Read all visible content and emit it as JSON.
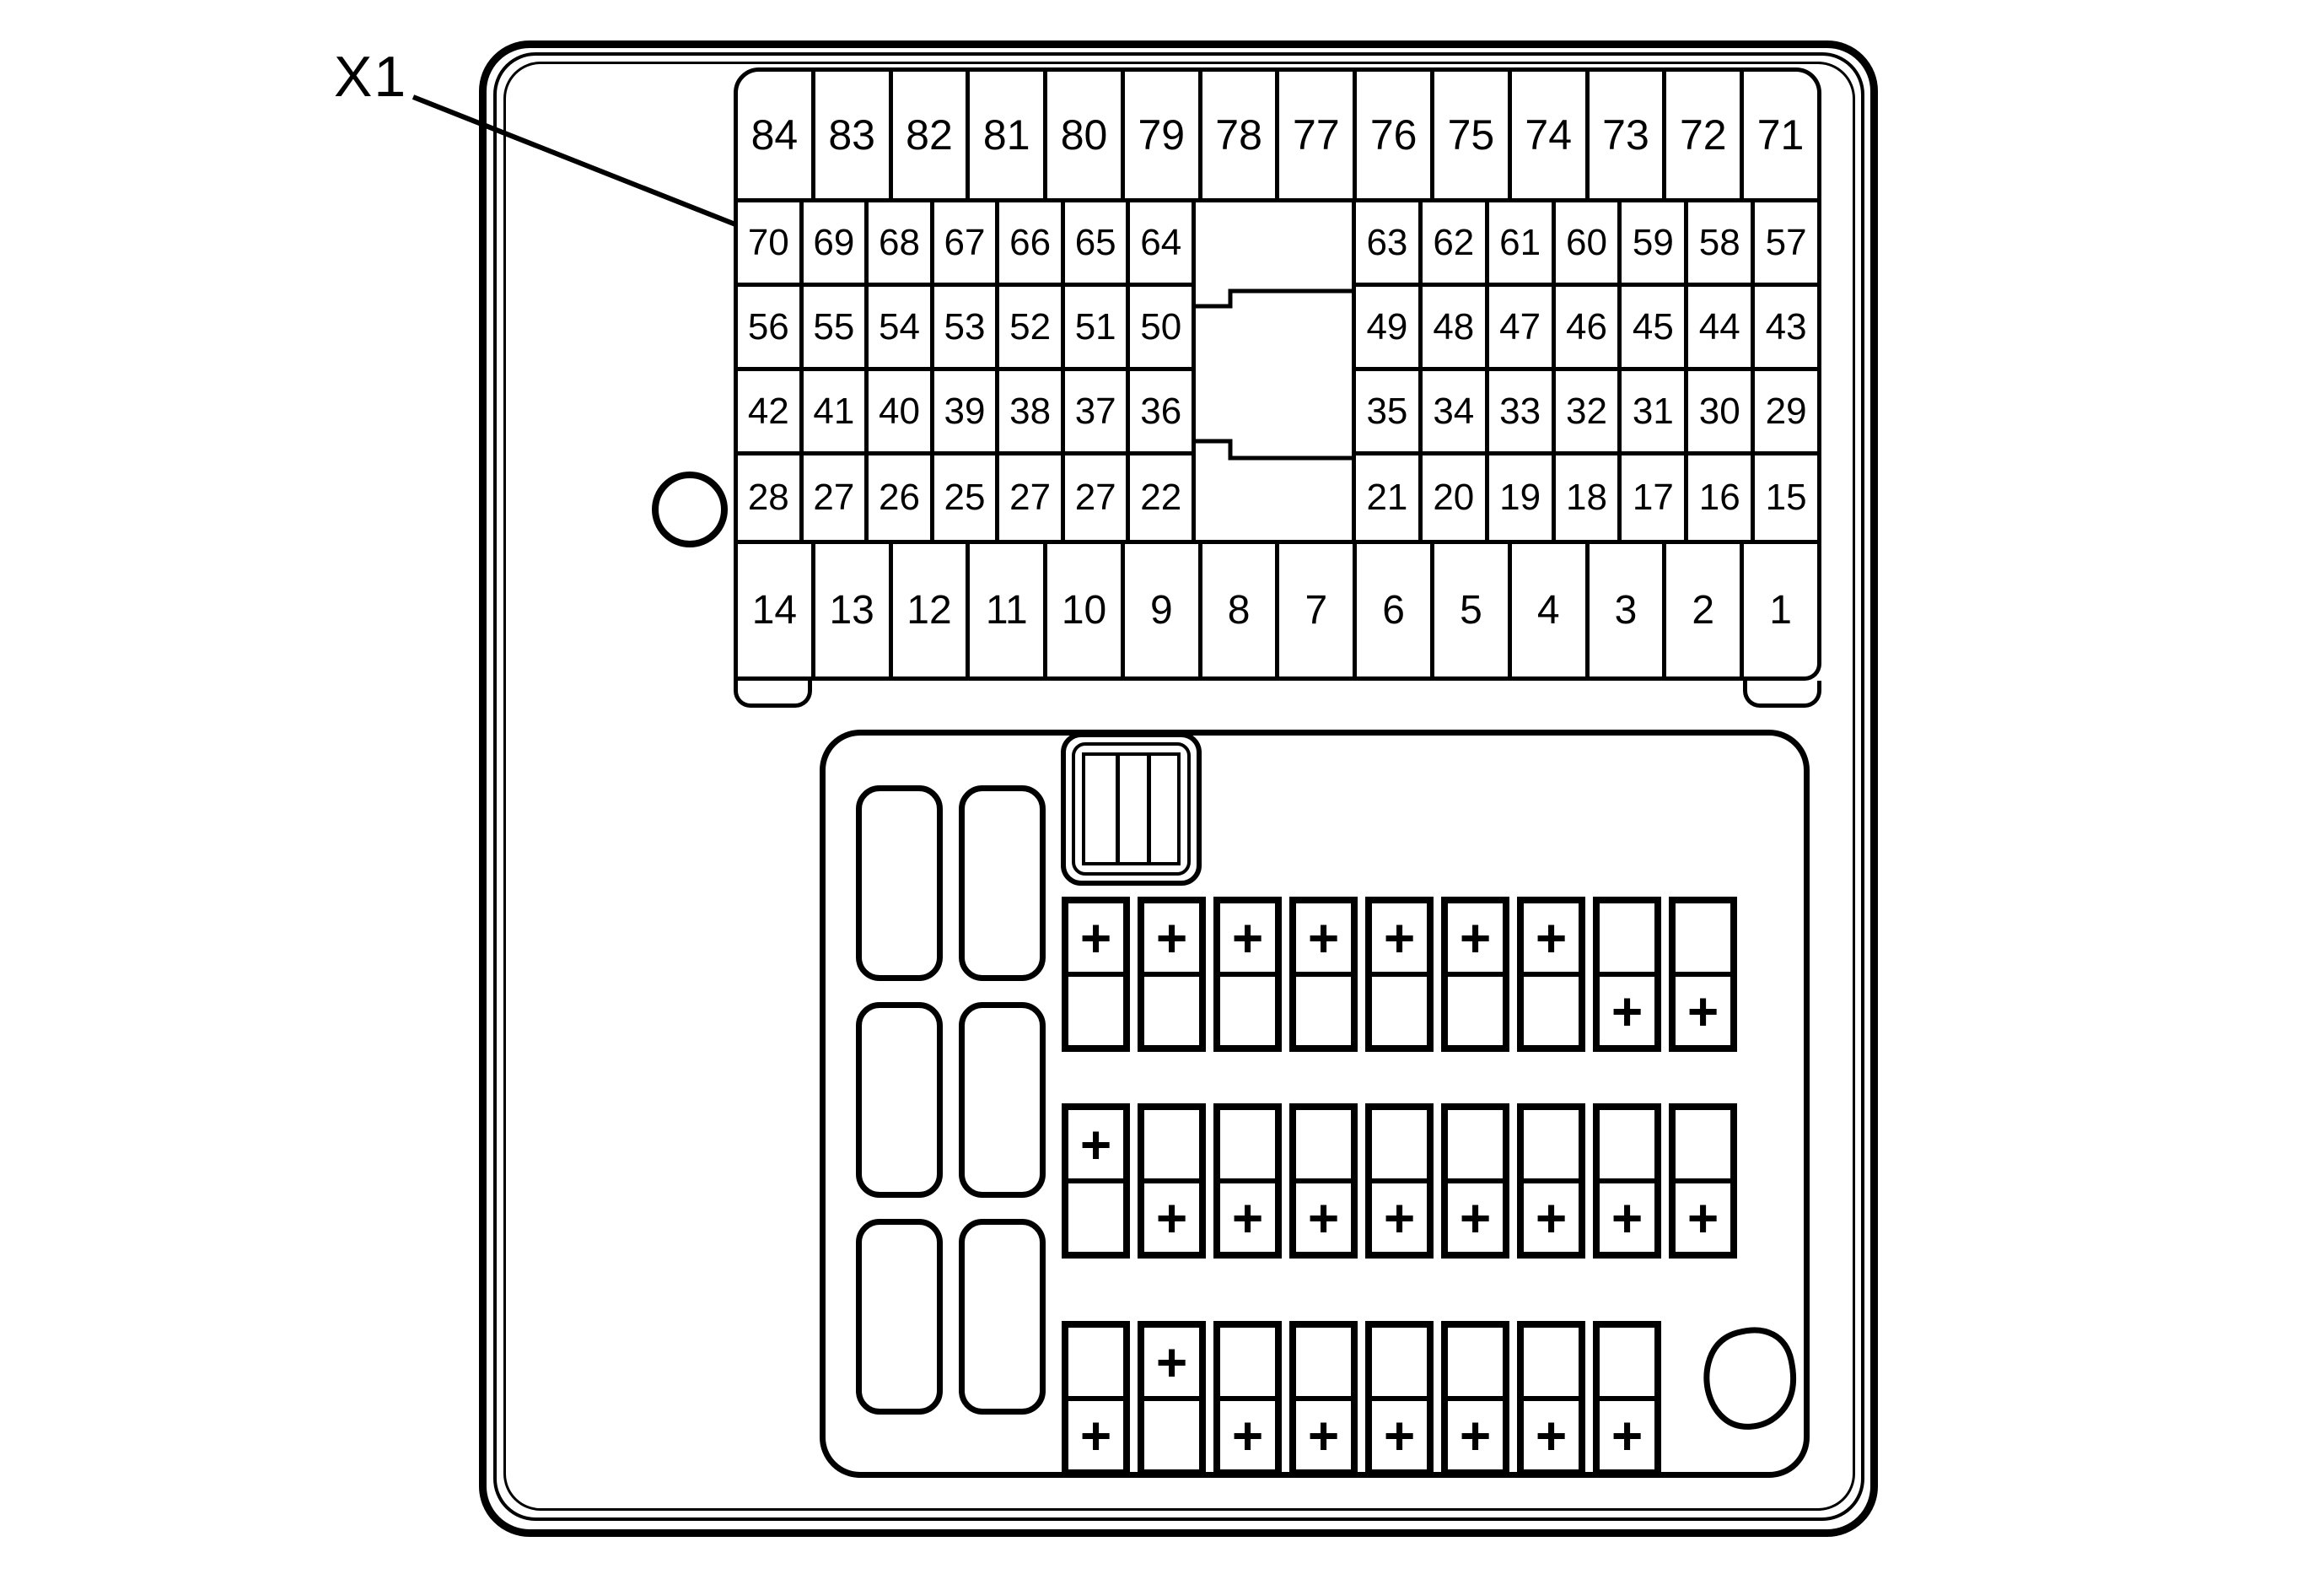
{
  "diagram": {
    "connector_label": "X1",
    "ink": "#000000",
    "paper": "#ffffff"
  },
  "pins": {
    "row1": [
      "84",
      "83",
      "82",
      "81",
      "80",
      "79",
      "78",
      "77",
      "76",
      "75",
      "74",
      "73",
      "72",
      "71"
    ],
    "row2_left": [
      "70",
      "69",
      "68",
      "67",
      "66",
      "65",
      "64"
    ],
    "row2_right": [
      "63",
      "62",
      "61",
      "60",
      "59",
      "58",
      "57"
    ],
    "row3_left": [
      "56",
      "55",
      "54",
      "53",
      "52",
      "51",
      "50"
    ],
    "row3_right": [
      "49",
      "48",
      "47",
      "46",
      "45",
      "44",
      "43"
    ],
    "row4_left": [
      "42",
      "41",
      "40",
      "39",
      "38",
      "37",
      "36"
    ],
    "row4_right": [
      "35",
      "34",
      "33",
      "32",
      "31",
      "30",
      "29"
    ],
    "row5_left": [
      "28",
      "27",
      "26",
      "25",
      "27",
      "27",
      "22"
    ],
    "row5_right": [
      "21",
      "20",
      "19",
      "18",
      "17",
      "16",
      "15"
    ],
    "row6": [
      "14",
      "13",
      "12",
      "11",
      "10",
      "9",
      "8",
      "7",
      "6",
      "5",
      "4",
      "3",
      "2",
      "1"
    ]
  },
  "fuses": {
    "row1": [
      {
        "top": "+",
        "bottom": ""
      },
      {
        "top": "+",
        "bottom": ""
      },
      {
        "top": "+",
        "bottom": ""
      },
      {
        "top": "+",
        "bottom": ""
      },
      {
        "top": "+",
        "bottom": ""
      },
      {
        "top": "+",
        "bottom": ""
      },
      {
        "top": "+",
        "bottom": ""
      },
      {
        "top": "",
        "bottom": "+"
      },
      {
        "top": "",
        "bottom": "+"
      }
    ],
    "row2": [
      {
        "top": "+",
        "bottom": ""
      },
      {
        "top": "",
        "bottom": "+"
      },
      {
        "top": "",
        "bottom": "+"
      },
      {
        "top": "",
        "bottom": "+"
      },
      {
        "top": "",
        "bottom": "+"
      },
      {
        "top": "",
        "bottom": "+"
      },
      {
        "top": "",
        "bottom": "+"
      },
      {
        "top": "",
        "bottom": "+"
      },
      {
        "top": "",
        "bottom": "+"
      }
    ],
    "row3": [
      {
        "top": "",
        "bottom": "+"
      },
      {
        "top": "+",
        "bottom": ""
      },
      {
        "top": "",
        "bottom": "+"
      },
      {
        "top": "",
        "bottom": "+"
      },
      {
        "top": "",
        "bottom": "+"
      },
      {
        "top": "",
        "bottom": "+"
      },
      {
        "top": "",
        "bottom": "+"
      },
      {
        "top": "",
        "bottom": "+"
      }
    ]
  }
}
